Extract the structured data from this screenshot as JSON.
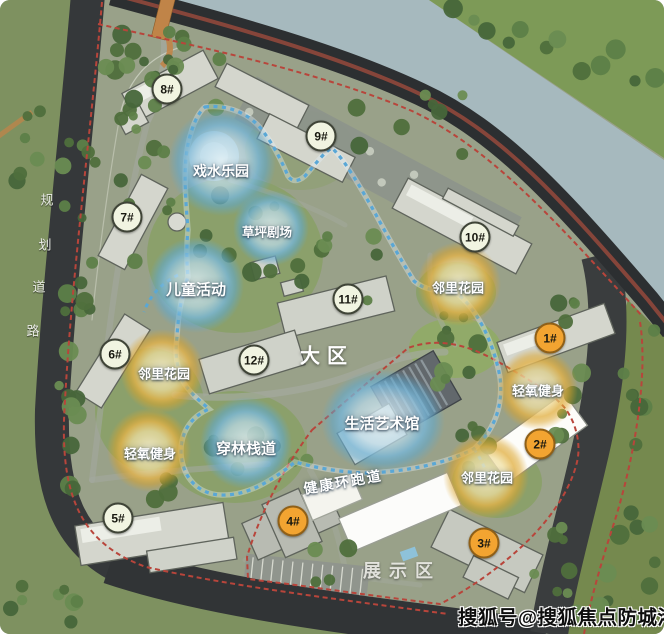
{
  "map": {
    "zones": {
      "main": "大区",
      "display": "展示区"
    },
    "track_label": "健康环跑道",
    "road": {
      "chars": [
        "规",
        "划",
        "道",
        "路"
      ]
    },
    "watermark": "搜狐号@搜狐焦点防城港站",
    "features": [
      {
        "id": "water-play-park",
        "label": "戏水乐园",
        "type": "blue"
      },
      {
        "id": "lawn-theater",
        "label": "草坪剧场",
        "type": "blue"
      },
      {
        "id": "children-activity",
        "label": "儿童活动",
        "type": "blue"
      },
      {
        "id": "forest-boardwalk",
        "label": "穿林栈道",
        "type": "blue"
      },
      {
        "id": "life-art-museum",
        "label": "生活艺术馆",
        "type": "blue"
      },
      {
        "id": "neighbor-garden-ne",
        "label": "邻里花园",
        "type": "yellow"
      },
      {
        "id": "neighbor-garden-w",
        "label": "邻里花园",
        "type": "yellow"
      },
      {
        "id": "oxygen-fitness-w",
        "label": "轻氧健身",
        "type": "yellow"
      },
      {
        "id": "oxygen-fitness-e",
        "label": "轻氧健身",
        "type": "yellow"
      },
      {
        "id": "neighbor-garden-se",
        "label": "邻里花园",
        "type": "yellow"
      }
    ],
    "buildings": [
      {
        "label": "1#",
        "style": "orange"
      },
      {
        "label": "2#",
        "style": "orange"
      },
      {
        "label": "3#",
        "style": "orange"
      },
      {
        "label": "4#",
        "style": "orange"
      },
      {
        "label": "5#",
        "style": "pale"
      },
      {
        "label": "6#",
        "style": "pale"
      },
      {
        "label": "7#",
        "style": "pale"
      },
      {
        "label": "8#",
        "style": "pale"
      },
      {
        "label": "9#",
        "style": "pale"
      },
      {
        "label": "10#",
        "style": "pale"
      },
      {
        "label": "11#",
        "style": "pale"
      },
      {
        "label": "12#",
        "style": "pale"
      }
    ],
    "colors": {
      "river": "#a6b9be",
      "road_dark": "#34373a",
      "outer_green": "#7e9160",
      "glow_blue": "#5fa9d0",
      "glow_yellow": "#e0a82e",
      "track_blue": "#59a7d6",
      "boundary_red": "#b8453b",
      "badge_orange": "#f2a431",
      "badge_pale": "#f1f4e1"
    }
  }
}
